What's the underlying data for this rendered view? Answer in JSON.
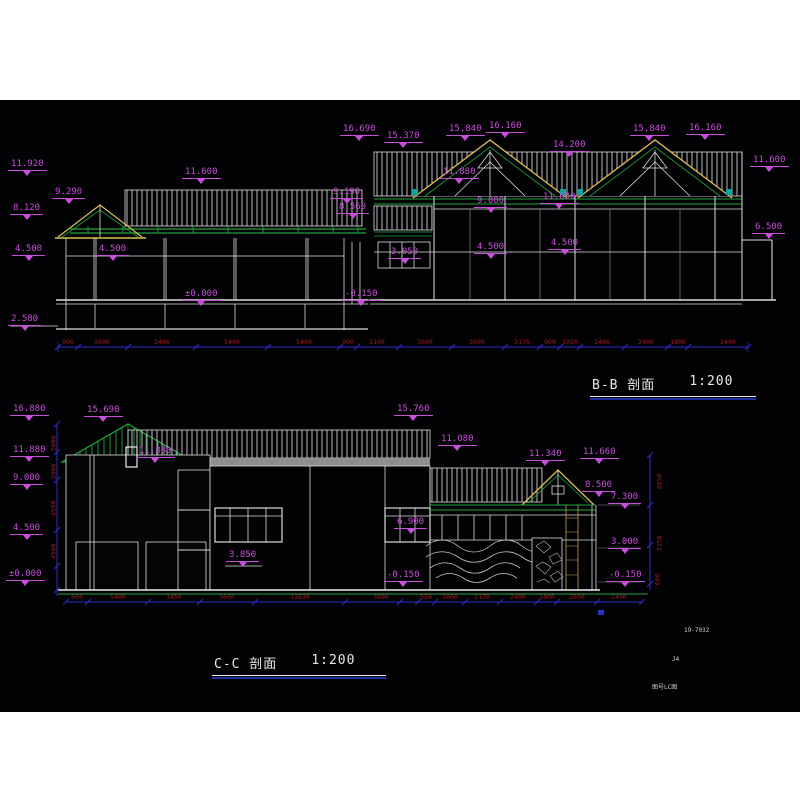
{
  "drawing": {
    "titles": {
      "bb": {
        "name": "B-B 剖面",
        "scale": "1:200"
      },
      "cc": {
        "name": "C-C 剖面",
        "scale": "1:200"
      }
    },
    "colors": {
      "canvas_bg": "#020205",
      "line_white": "#dcdcdc",
      "line_green": "#1fa33a",
      "line_yellow": "#d8c050",
      "dim_blue": "#2e2ecb",
      "dim_red": "#9c1f1f",
      "level_magenta": "#cb4ddb",
      "slab_gray": "#8f8f8f",
      "cyan": "#0aa6a6"
    },
    "levels_top": [
      {
        "t": "11.920",
        "x": 8,
        "y": 160
      },
      {
        "t": "9.290",
        "x": 52,
        "y": 188
      },
      {
        "t": "8.120",
        "x": 10,
        "y": 204
      },
      {
        "t": "4.500",
        "x": 12,
        "y": 245
      },
      {
        "t": "4.500",
        "x": 96,
        "y": 245
      },
      {
        "t": "2.580",
        "x": 8,
        "y": 315
      },
      {
        "t": "11.600",
        "x": 182,
        "y": 168
      },
      {
        "t": "±0.000",
        "x": 182,
        "y": 290
      },
      {
        "t": "9.190",
        "x": 330,
        "y": 188
      },
      {
        "t": "8.560",
        "x": 336,
        "y": 203
      },
      {
        "t": "-0.150",
        "x": 342,
        "y": 290
      },
      {
        "t": "3.050",
        "x": 388,
        "y": 248
      },
      {
        "t": "16.690",
        "x": 340,
        "y": 125
      },
      {
        "t": "15.370",
        "x": 384,
        "y": 132
      },
      {
        "t": "15.840",
        "x": 446,
        "y": 125
      },
      {
        "t": "16.160",
        "x": 486,
        "y": 122
      },
      {
        "t": "11.880",
        "x": 440,
        "y": 168
      },
      {
        "t": "9.080",
        "x": 474,
        "y": 197
      },
      {
        "t": "11.600",
        "x": 540,
        "y": 193
      },
      {
        "t": "4.500",
        "x": 474,
        "y": 243
      },
      {
        "t": "4.500",
        "x": 548,
        "y": 239
      },
      {
        "t": "14.200",
        "x": 550,
        "y": 141
      },
      {
        "t": "15.840",
        "x": 630,
        "y": 125
      },
      {
        "t": "16.160",
        "x": 686,
        "y": 124
      },
      {
        "t": "11.600",
        "x": 750,
        "y": 156
      },
      {
        "t": "6.500",
        "x": 752,
        "y": 223
      }
    ],
    "levels_bottom": [
      {
        "t": "16.880",
        "x": 10,
        "y": 405
      },
      {
        "t": "15.690",
        "x": 84,
        "y": 406
      },
      {
        "t": "11.880",
        "x": 10,
        "y": 446
      },
      {
        "t": "11.880",
        "x": 136,
        "y": 447
      },
      {
        "t": "9.080",
        "x": 10,
        "y": 474
      },
      {
        "t": "4.500",
        "x": 10,
        "y": 524
      },
      {
        "t": "±0.000",
        "x": 6,
        "y": 570
      },
      {
        "t": "15.760",
        "x": 394,
        "y": 405
      },
      {
        "t": "11.080",
        "x": 438,
        "y": 435
      },
      {
        "t": "6.900",
        "x": 394,
        "y": 518
      },
      {
        "t": "3.850",
        "x": 226,
        "y": 551
      },
      {
        "t": "-0.150",
        "x": 384,
        "y": 571
      },
      {
        "t": "11.340",
        "x": 526,
        "y": 450
      },
      {
        "t": "11.660",
        "x": 580,
        "y": 448
      },
      {
        "t": "8.500",
        "x": 582,
        "y": 481
      },
      {
        "t": "7.300",
        "x": 608,
        "y": 493
      },
      {
        "t": "3.000",
        "x": 608,
        "y": 538
      },
      {
        "t": "-0.150",
        "x": 606,
        "y": 571
      }
    ],
    "dims_top": {
      "y": 339,
      "items": [
        {
          "t": "900",
          "x": 68
        },
        {
          "t": "3600",
          "x": 102
        },
        {
          "t": "5400",
          "x": 162
        },
        {
          "t": "5400",
          "x": 232
        },
        {
          "t": "5400",
          "x": 304
        },
        {
          "t": "900",
          "x": 348
        },
        {
          "t": "2100",
          "x": 377
        },
        {
          "t": "3600",
          "x": 425
        },
        {
          "t": "3600",
          "x": 477
        },
        {
          "t": "3170",
          "x": 522
        },
        {
          "t": "900",
          "x": 550
        },
        {
          "t": "1020",
          "x": 570
        },
        {
          "t": "2400",
          "x": 602
        },
        {
          "t": "2400",
          "x": 646
        },
        {
          "t": "1800",
          "x": 678
        },
        {
          "t": "2400",
          "x": 728
        }
      ]
    },
    "dims_bottom": {
      "y": 594,
      "items": [
        {
          "t": "600",
          "x": 77
        },
        {
          "t": "5400",
          "x": 118
        },
        {
          "t": "3450",
          "x": 174
        },
        {
          "t": "3600",
          "x": 227
        },
        {
          "t": "13630",
          "x": 300
        },
        {
          "t": "3600",
          "x": 381
        },
        {
          "t": "550",
          "x": 426
        },
        {
          "t": "1600",
          "x": 450
        },
        {
          "t": "3170",
          "x": 482
        },
        {
          "t": "2400",
          "x": 518
        },
        {
          "t": "1800",
          "x": 547
        },
        {
          "t": "2600",
          "x": 577
        },
        {
          "t": "2400",
          "x": 619
        }
      ]
    },
    "dims_vertical_left": [
      {
        "t": "5000",
        "x": 46,
        "y": 440
      },
      {
        "t": "2800",
        "x": 46,
        "y": 468
      },
      {
        "t": "4580",
        "x": 46,
        "y": 505
      },
      {
        "t": "4500",
        "x": 46,
        "y": 548
      }
    ],
    "dims_vertical_right": [
      {
        "t": "8650",
        "x": 652,
        "y": 478
      },
      {
        "t": "3150",
        "x": 652,
        "y": 540
      },
      {
        "t": "600",
        "x": 652,
        "y": 576
      }
    ],
    "corner_texts": [
      {
        "t": "19-7032",
        "x": 684,
        "y": 628
      },
      {
        "t": "J4",
        "x": 672,
        "y": 657
      },
      {
        "t": "图号LC图",
        "x": 652,
        "y": 685
      }
    ]
  }
}
